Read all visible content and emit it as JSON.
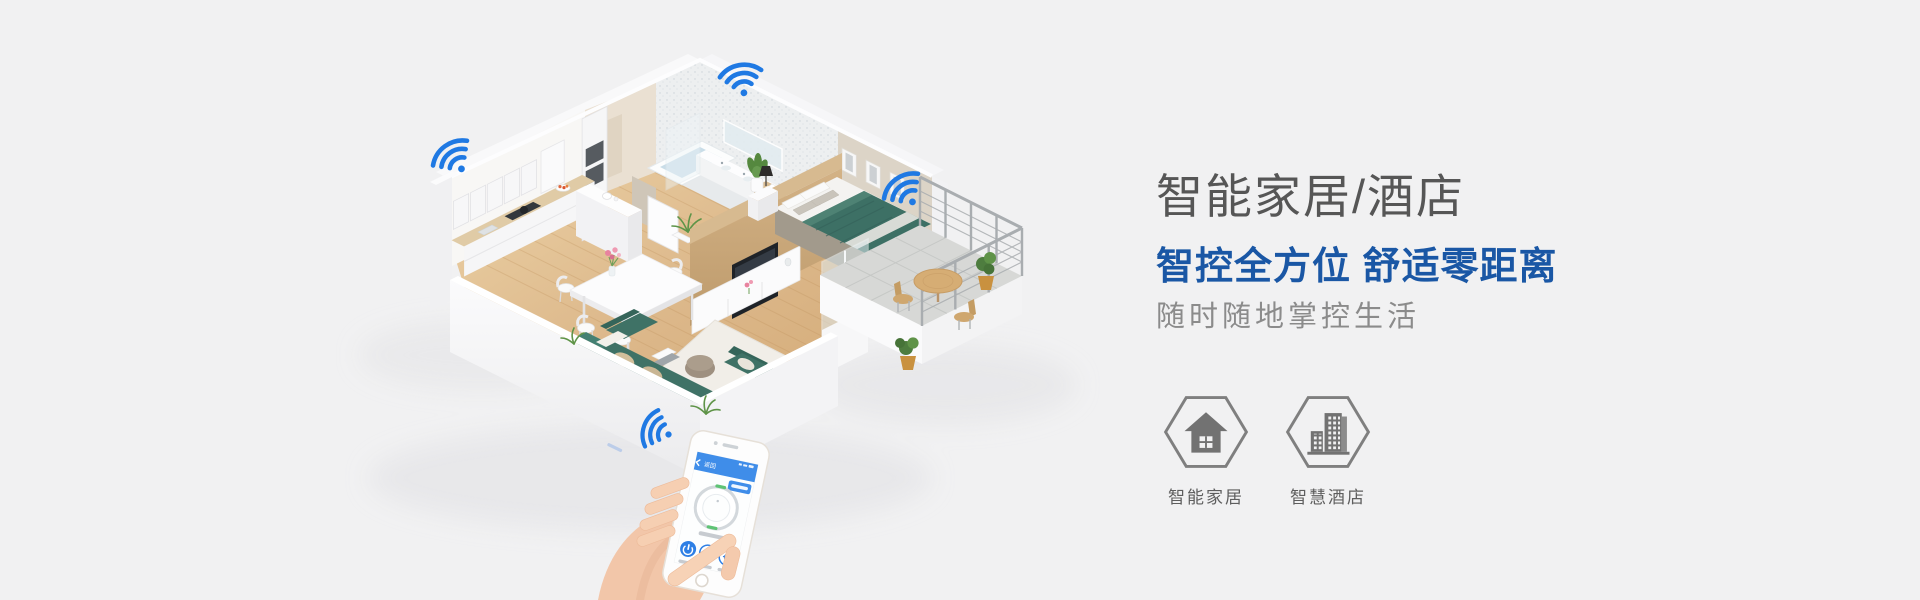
{
  "page": {
    "background_color": "#f1f1f2",
    "width": 1920,
    "height": 600
  },
  "hero_text": {
    "title": "智能家居/酒店",
    "headline": "智控全方位 舒适零距离",
    "tagline": "随时随地掌控生活",
    "title_color": "#565656",
    "headline_color": "#1a57a5",
    "tagline_color": "#8b8b8b"
  },
  "features": [
    {
      "label": "智能家居",
      "icon": "house-icon"
    },
    {
      "label": "智慧酒店",
      "icon": "hotel-buildings-icon"
    }
  ],
  "illustration": {
    "type": "isometric-smart-apartment-cutaway",
    "rooms": [
      "kitchen",
      "dining",
      "living-room",
      "bathroom",
      "bedroom",
      "balcony"
    ],
    "wifi_signal_color": "#1f79e3",
    "wifi_signal_count": 4,
    "phone_app": {
      "back_label": "返回",
      "header_color": "#3f8de9",
      "accent_color": "#2e7fe5"
    }
  }
}
